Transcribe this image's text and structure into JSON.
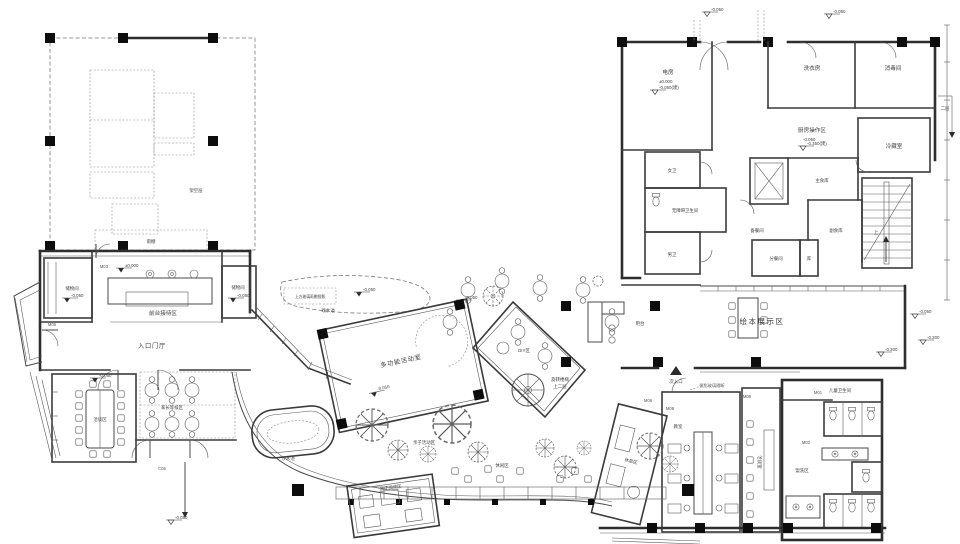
{
  "drawing": {
    "bg": "#ffffff",
    "line": "#3a3a3a",
    "accent": "#0d0d0d"
  },
  "rooms": {
    "stilt_area": {
      "label": "架空层"
    },
    "canopy": {
      "label": "雨棚"
    },
    "storage_left": {
      "label": "储物间"
    },
    "reception": {
      "label": "前台接待区"
    },
    "storage_right": {
      "label": "储物间"
    },
    "entry_hall": {
      "label": "入口门厅"
    },
    "talk_area": {
      "label": "洽谈区"
    },
    "waiting_area": {
      "label": "家长等候区"
    },
    "water_pool": {
      "label": "戏水池",
      "note": "上方玻璃雨棚投影"
    },
    "multi_room": {
      "label": "多功能活动室"
    },
    "diy_room": {
      "label": "DIY区"
    },
    "spiral_stair": {
      "label": "旋转楼梯",
      "note": "上二层"
    },
    "bar": {
      "label": "吧台"
    },
    "display_room": {
      "label": "绘本展示区"
    },
    "side_entry": {
      "label": "次入口"
    },
    "power_room": {
      "label": "电房"
    },
    "laundry": {
      "label": "洗衣房"
    },
    "disinfection": {
      "label": "消毒间"
    },
    "kitchen": {
      "label": "厨房操作区"
    },
    "cold_room": {
      "label": "冷藏室"
    },
    "women_wc": {
      "label": "女卫"
    },
    "accessible_wc": {
      "label": "无障碍卫生间"
    },
    "men_wc": {
      "label": "男卫"
    },
    "prep_room": {
      "label": "备餐间"
    },
    "staple_store": {
      "label": "主食库"
    },
    "side_store": {
      "label": "副食库"
    },
    "serving_room": {
      "label": "分餐间"
    },
    "small_store": {
      "label": "库"
    },
    "stair_up": {
      "label": "上"
    },
    "level2": {
      "label": "二层"
    },
    "kids_wc": {
      "label": "儿童卫生间"
    },
    "wash_area": {
      "label": "盥洗区"
    },
    "rest_area": {
      "label": "休息区"
    },
    "classroom": {
      "label": "教室"
    },
    "meeting_room": {
      "label": "洽谈室"
    },
    "sand_pool": {
      "label": "沙水池"
    },
    "family_zone": {
      "label": "亲子活动区"
    },
    "leisure_zone": {
      "label": "休闲区"
    },
    "reading_room": {
      "label": "亲子阅读区"
    },
    "glass_note": {
      "label": "弧形玻璃隔断"
    }
  },
  "door_tags": {
    "m01": "M01",
    "m02": "M02",
    "m03": "M03",
    "m05": "M05",
    "m06": "M06",
    "m08": "M08",
    "m09": "M09",
    "c05": "C05"
  },
  "elevations": {
    "zero": "±0.000",
    "m05": "-0.050",
    "m30": "-0.300",
    "m05b": "-0.050(建)",
    "m35b": "-0.350(建)"
  }
}
